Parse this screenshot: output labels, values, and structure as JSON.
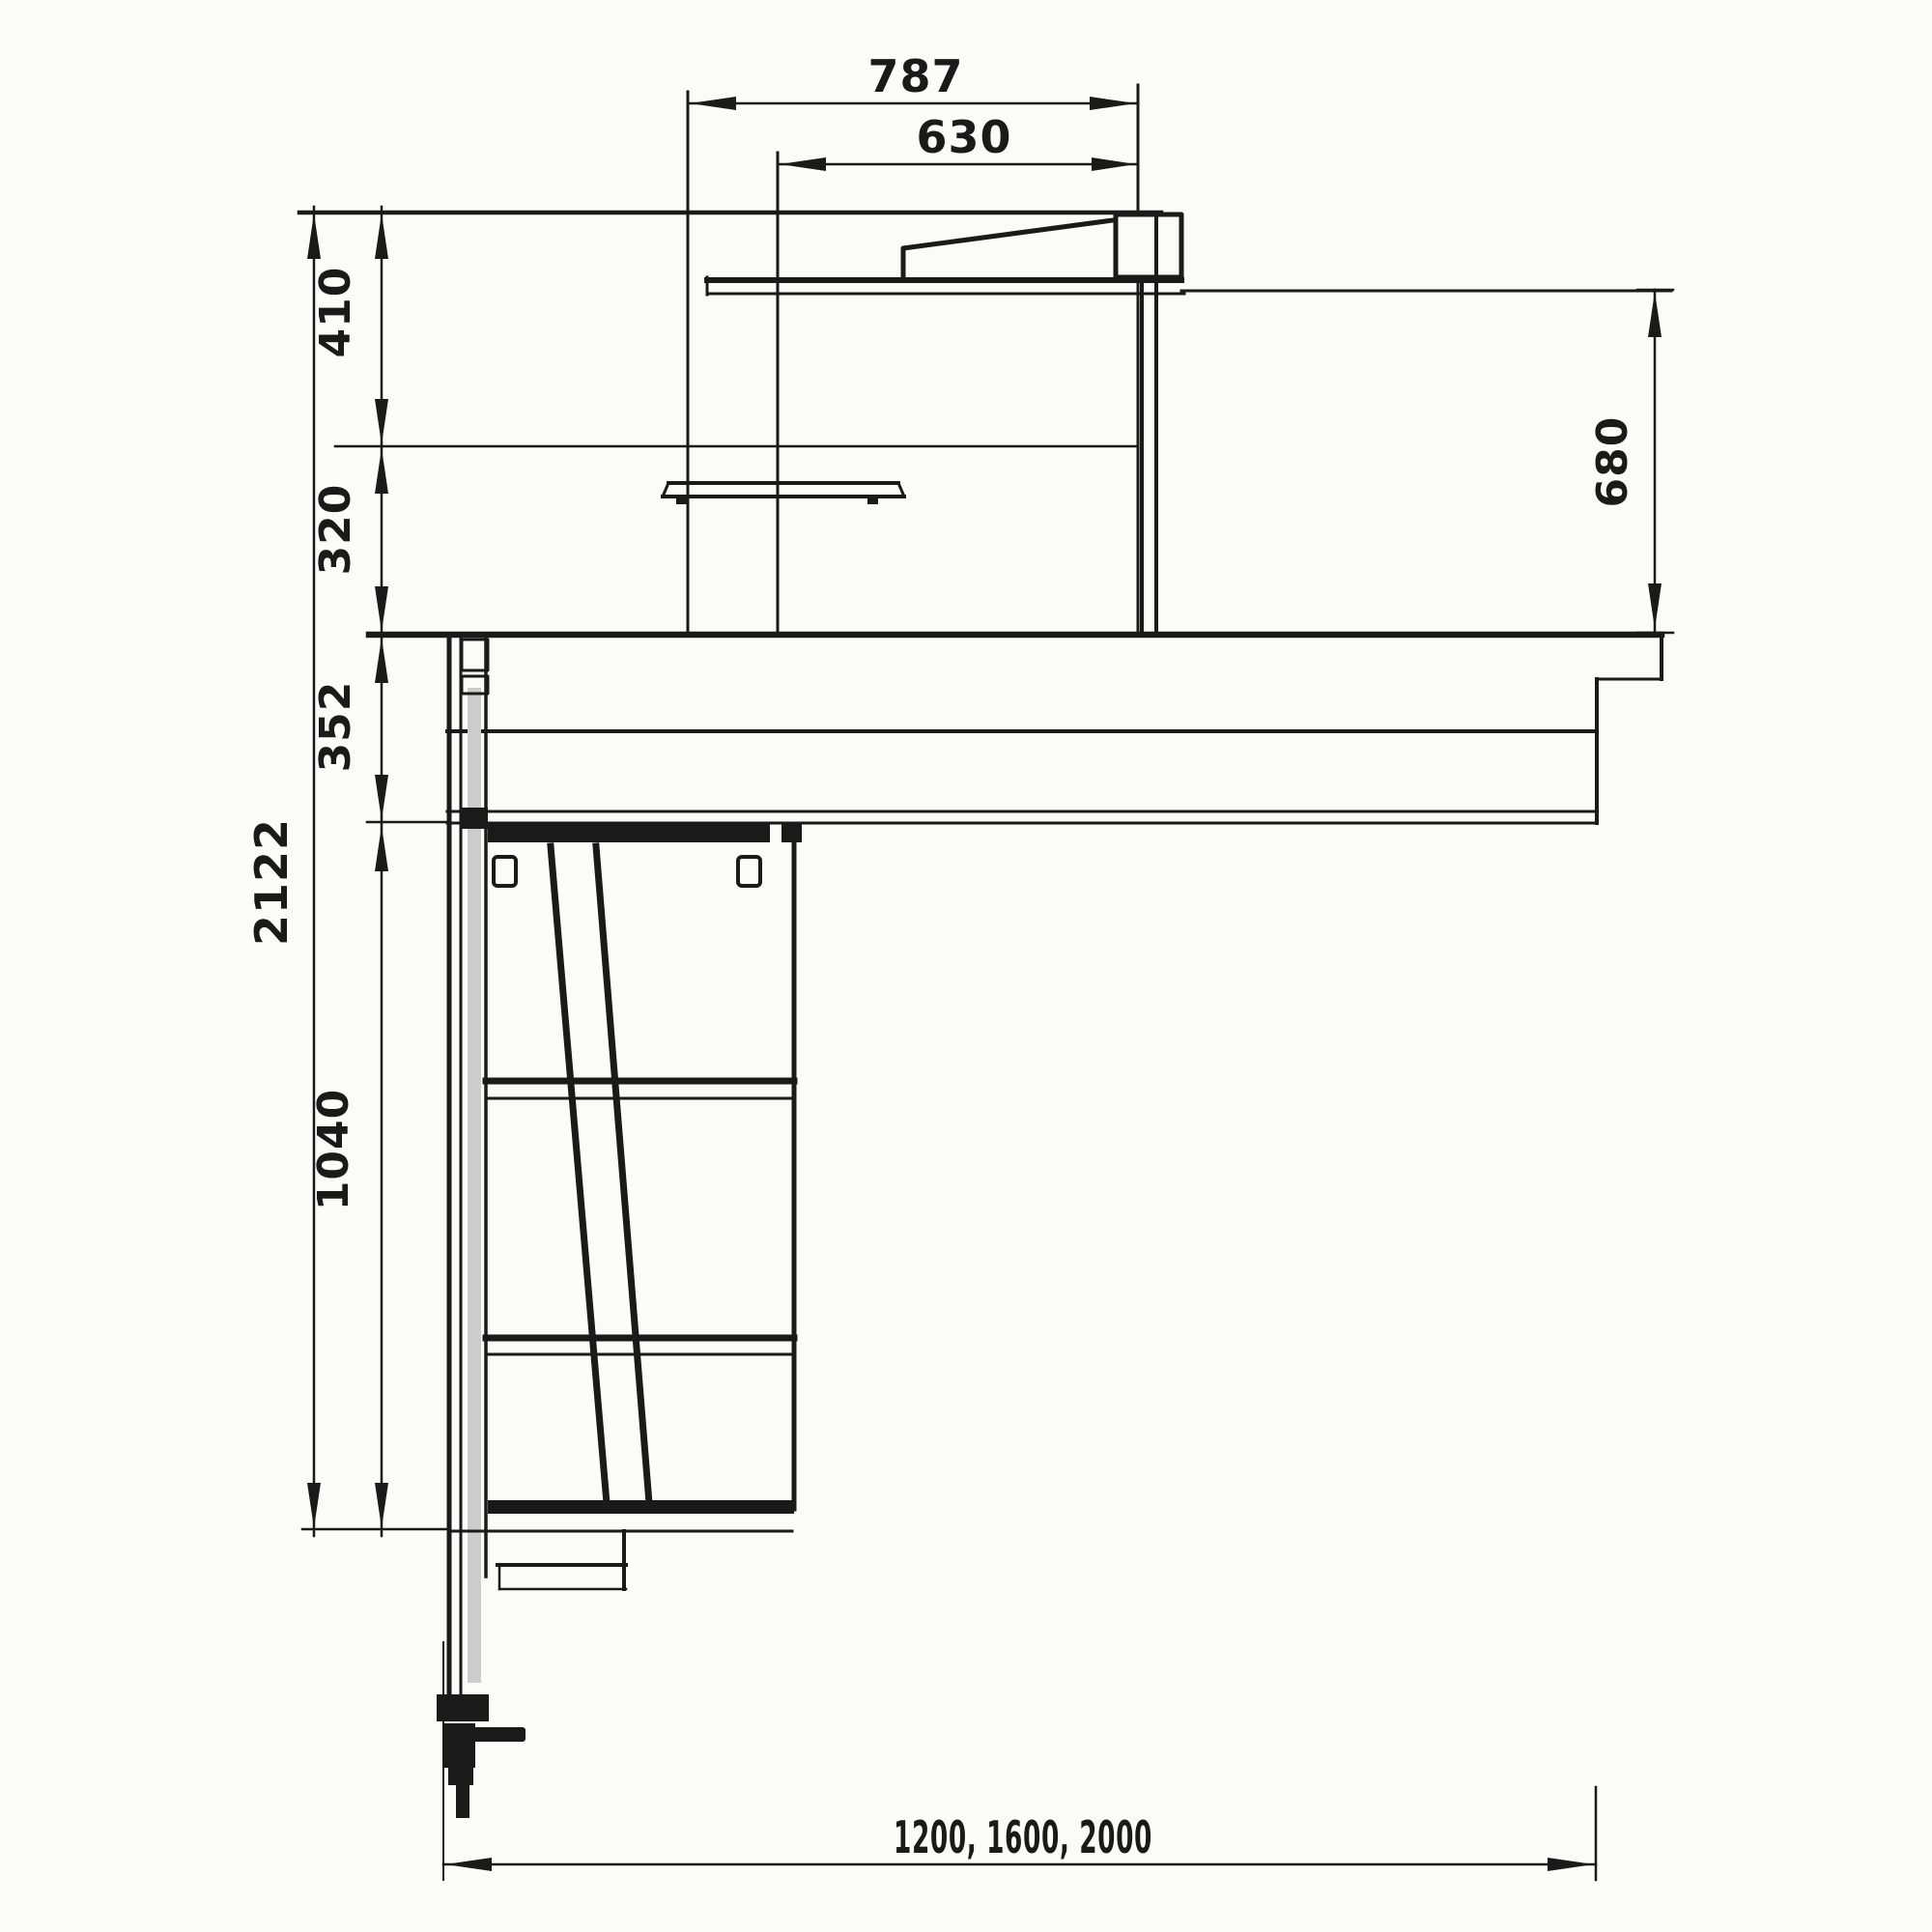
{
  "drawing": {
    "type": "technical-dimension-drawing",
    "subject": "counter unit side cross-section",
    "dimensions": {
      "top_width": "787",
      "top_width_inner": "630",
      "upper_seg1": "410",
      "upper_seg2": "320",
      "counter_seg": "352",
      "overall_height": "2122",
      "cabinet_seg": "1040",
      "display_height": "680",
      "width_options": "1200, 1600, 2000"
    }
  },
  "colors": {
    "ink": "#1a1a1a",
    "paper": "#fbfbfa"
  }
}
